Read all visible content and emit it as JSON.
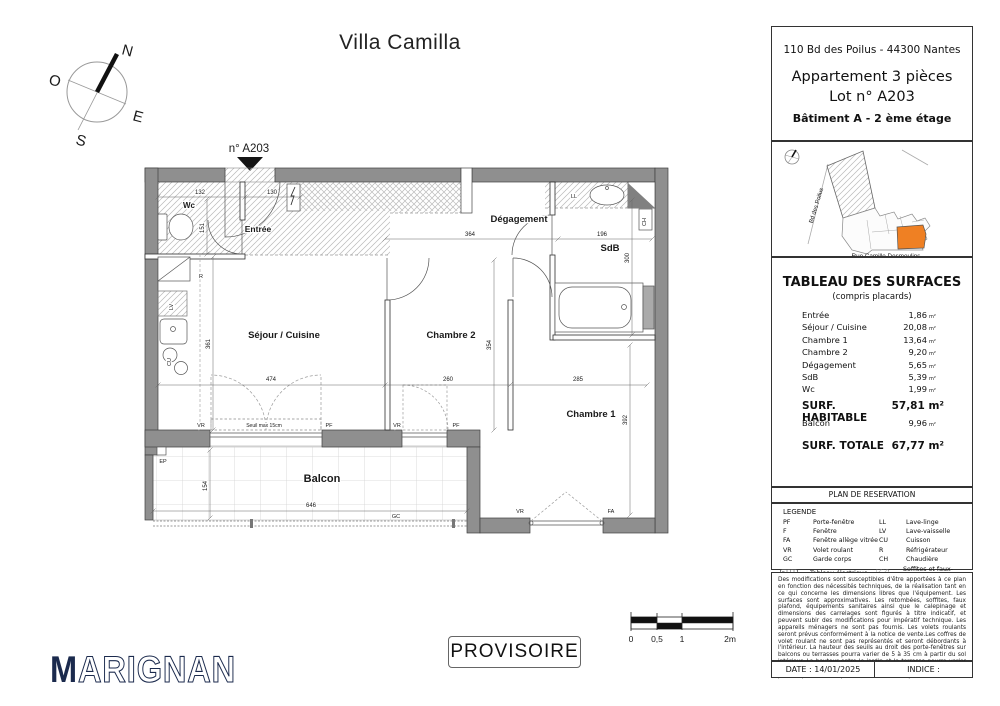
{
  "title": "Villa Camilla",
  "compass": {
    "n": "N",
    "o": "O",
    "e": "E",
    "s": "S"
  },
  "plan": {
    "marker": "n° A203",
    "rooms": {
      "wc": "Wc",
      "entree": "Entrée",
      "degagement": "Dégagement",
      "sdb": "SdB",
      "sejour": "Séjour / Cuisine",
      "chambre2": "Chambre 2",
      "chambre1": "Chambre 1",
      "balcon": "Balcon"
    },
    "dims": {
      "wc_w": "132",
      "entry_w": "130",
      "wc_h": "151",
      "deg_w": "364",
      "sdb_w": "196",
      "sdb_h": "300",
      "sejour_w": "474",
      "sejour_h": "361",
      "ch2_w": "260",
      "ch2_h": "354",
      "ch1_w": "285",
      "ch1_h": "392",
      "balcon_w": "646",
      "balcon_h": "154",
      "seuil": "Seuil max 15cm"
    },
    "equipment": {
      "r": "R",
      "lv": "LV",
      "cu": "CU",
      "ll": "LL",
      "ch": "CH",
      "ep": "EP",
      "gc": "GC",
      "vr": "VR",
      "pf": "PF",
      "fa": "FA"
    }
  },
  "sidebar": {
    "address": "110 Bd des Poilus - 44300 Nantes",
    "apartment": {
      "line1": "Appartement 3 pièces",
      "line2": "Lot n° A203",
      "line3": "Bâtiment A - 2 ème étage"
    },
    "map": {
      "street_left": "Bd des Poilus",
      "street_bottom": "Rue Camille Desmoulins",
      "highlight_color": "#ef8023"
    },
    "surfaces": {
      "title": "TABLEAU DES SURFACES",
      "subtitle": "(compris placards)",
      "unit": "m²",
      "rows": [
        {
          "label": "Entrée",
          "value": "1,86"
        },
        {
          "label": "Séjour / Cuisine",
          "value": "20,08"
        },
        {
          "label": "Chambre 1",
          "value": "13,64"
        },
        {
          "label": "Chambre 2",
          "value": "9,20"
        },
        {
          "label": "Dégagement",
          "value": "5,65"
        },
        {
          "label": "SdB",
          "value": "5,39"
        },
        {
          "label": "Wc",
          "value": "1,99"
        }
      ],
      "habitable": {
        "label": "SURF. HABITABLE",
        "value": "57,81 m²"
      },
      "balcon": {
        "label": "Balcon",
        "value": "9,96"
      },
      "totale": {
        "label": "SURF. TOTALE",
        "value": "67,77 m²"
      }
    },
    "plan_reservation": "PLAN DE RESERVATION",
    "legend": {
      "title": "LEGENDE",
      "col1": [
        {
          "abbr": "PF",
          "label": "Porte-fenêtre"
        },
        {
          "abbr": "F",
          "label": "Fenêtre"
        },
        {
          "abbr": "FA",
          "label": "Fenêtre allège vitrée"
        },
        {
          "abbr": "VR",
          "label": "Volet roulant"
        },
        {
          "abbr": "GC",
          "label": "Garde corps"
        }
      ],
      "col2": [
        {
          "abbr": "LL",
          "label": "Lave-linge"
        },
        {
          "abbr": "LV",
          "label": "Lave-vaisselle"
        },
        {
          "abbr": "CU",
          "label": "Cuisson"
        },
        {
          "abbr": "R",
          "label": "Réfrigérateur"
        },
        {
          "abbr": "CH",
          "label": "Chaudière"
        }
      ],
      "extra1": "Tableau électrique",
      "extra2": "Soffites et faux-plafond"
    },
    "notes": "Des modifications sont susceptibles d'être apportées à ce plan en fonction des nécessités techniques, de la réalisation tant en ce qui concerne les dimensions libres que l'équipement. Les surfaces sont approximatives. Les retombées, soffites, faux plafond, équipements sanitaires ainsi que le calepinage et dimensions des carrelages sont figurés à titre indicatif, et peuvent subir des modifications pour impératif technique. Les appareils ménagers ne sont pas fournis. Les volets roulants seront prévus conformément à la notice de vente.Les coffres de volet roulant ne sont pas représentés et seront débordants à l'intérieur. La hauteur des seuils au droit des porte-fenêtres sur balcons ou terrasses pourra varier de 5 à 35 cm à partir du sol intérieur. La hauteur entre le jardin et la terrasse pourra varier entre 0 et 60 cm. Les jardins ne seront pas nécessairement plats et pourront comporter des talus et des pentes.",
    "date": "DATE : 14/01/2025",
    "indice": "INDICE :"
  },
  "footer": {
    "logo_m": "M",
    "logo_rest": "ARIGNAN",
    "stamp": "PROVISOIRE",
    "scale": [
      "0",
      "0,5",
      "1",
      "2m"
    ]
  },
  "colors": {
    "accent_orange": "#ef8023",
    "logo_navy": "#1b2a4d",
    "wall_gray": "#8f8f8f"
  }
}
